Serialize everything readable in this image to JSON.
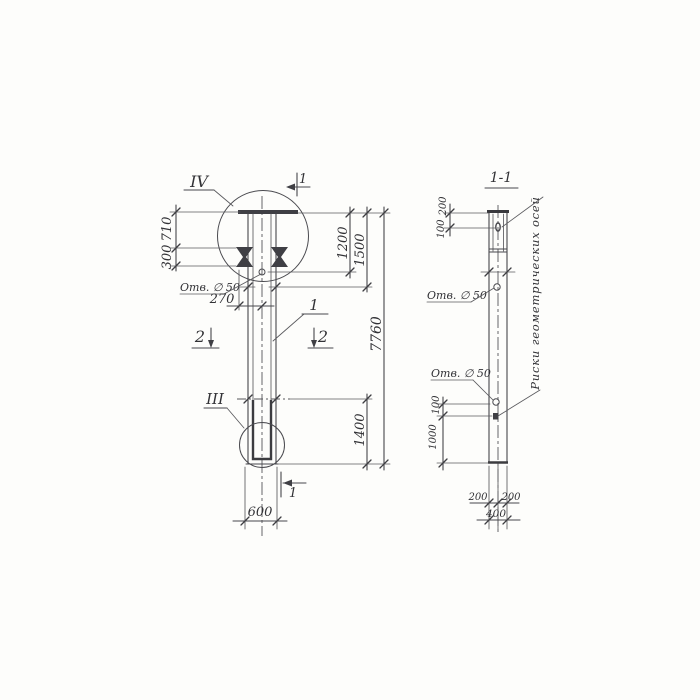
{
  "canvas": {
    "background": "#fdfdfb",
    "ink": "#47474c"
  },
  "left_view": {
    "detail_label_top": "IV",
    "detail_label_bottom": "III",
    "section_mark_top": "1",
    "section_mark_bottom": "1",
    "section_mark_2_left": "2",
    "section_mark_2_right": "2",
    "part_callout": "1",
    "hole_label": "Отв. ∅ 50",
    "dim_710": "710",
    "dim_300": "300",
    "dim_270": "270",
    "dim_600": "600",
    "dim_1200": "1200",
    "dim_1500": "1500",
    "dim_7760": "7760",
    "dim_1400": "1400"
  },
  "section_view": {
    "title": "1-1",
    "hole_label_upper": "Отв. ∅ 50",
    "hole_label_lower": "Отв. ∅ 50",
    "axes_note": "Риски геометрических осей",
    "dim_200_top": "200",
    "dim_100_top": "100",
    "dim_100_bottom": "100",
    "dim_1000": "1000",
    "dim_200_left": "200",
    "dim_200_right": "200",
    "dim_400": "400"
  }
}
